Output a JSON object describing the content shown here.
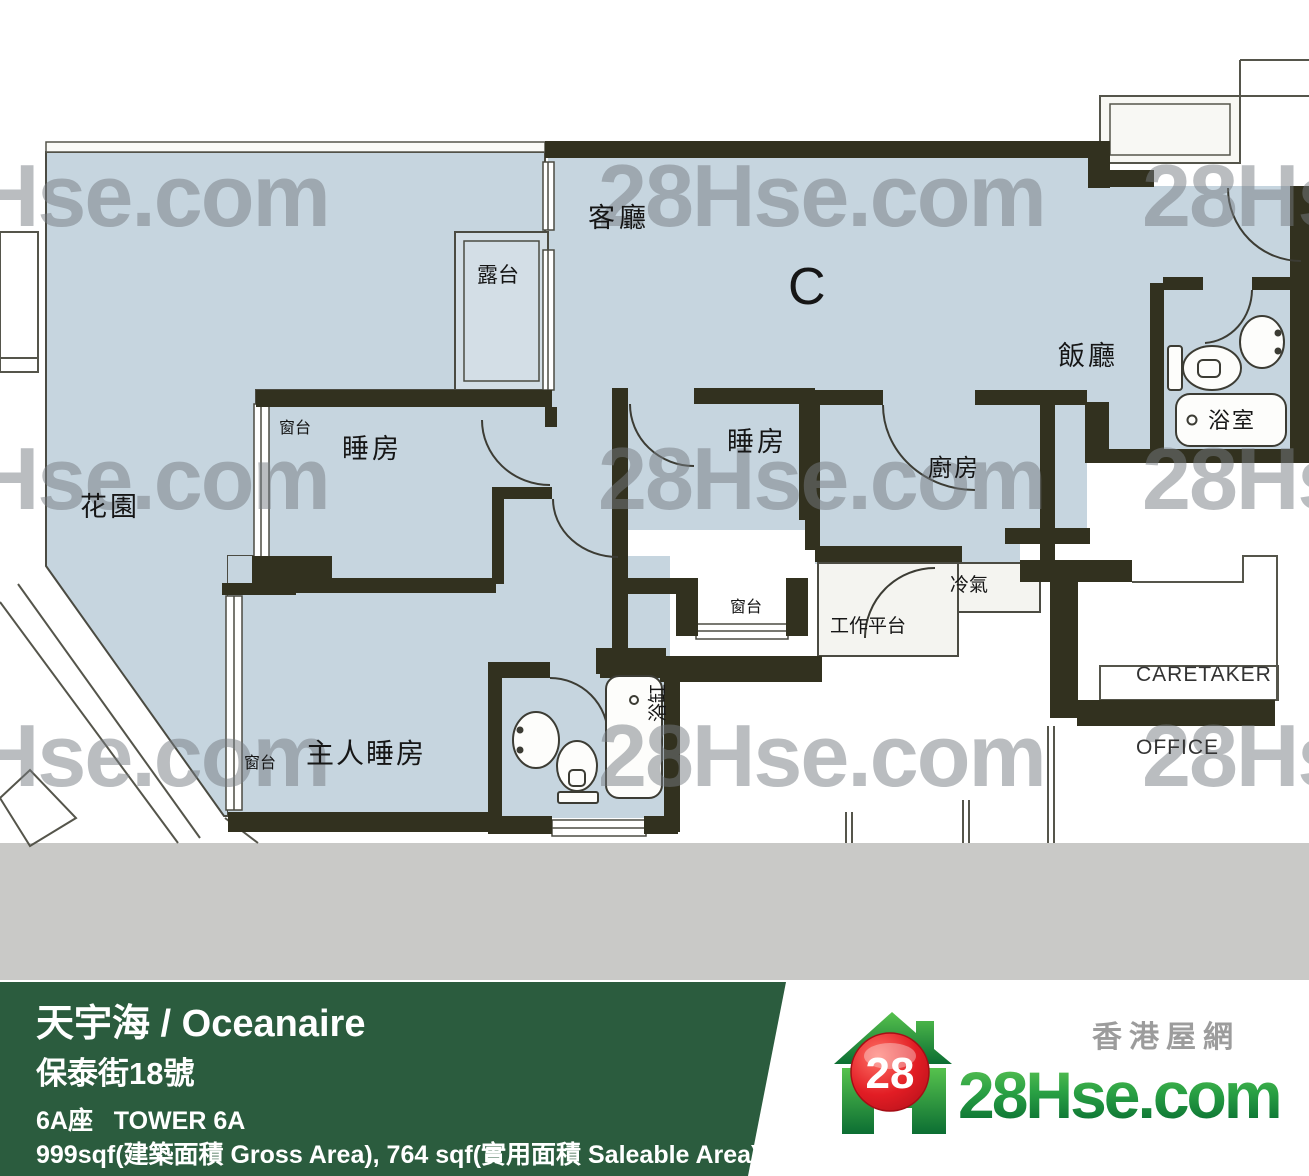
{
  "plan": {
    "watermark": "28Hse.com",
    "unit": "C",
    "living_room": "客廳",
    "balcony": "露台",
    "garden": "花園",
    "bedroom1": "睡房",
    "bedroom2": "睡房",
    "bay_window1": "窗台",
    "bay_window2": "窗台",
    "bay_window_master": "窗台",
    "kitchen": "廚房",
    "dining": "飯廳",
    "bathroom": "浴室",
    "bathtub": "浴缸",
    "ac_platform": "冷氣",
    "utility_platform": "工作平台",
    "master_bedroom": "主人睡房",
    "caretaker_line1": "CARETAKER",
    "caretaker_line2": "OFFICE"
  },
  "footer": {
    "title": "天宇海 / Oceanaire",
    "address": "保泰街18號",
    "tower": "6A座   TOWER 6A",
    "area": "999sqf(建築面積 Gross Area), 764 sqf(實用面積 Saleable Area)",
    "bar_color": "#2b5c3e"
  },
  "logo": {
    "site_cn": "香港屋網",
    "brand": "28Hse.com",
    "badge": "28",
    "green_light": "#56c24d",
    "green_dark": "#0c6e33",
    "red": "#e21d24"
  },
  "colors": {
    "floor": "#c6d5df",
    "wall": "#32311f",
    "watermark_gray": "#7a7f85",
    "gray_band": "#c9c9c7"
  }
}
